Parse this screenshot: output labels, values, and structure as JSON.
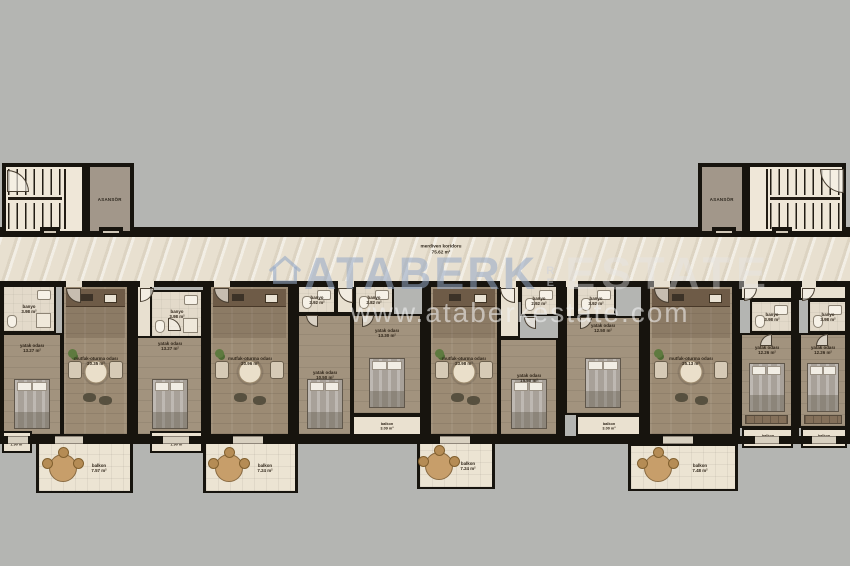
{
  "watermark": {
    "brand": "ATABERK",
    "mid": "RE",
    "brand2": "ESTATE",
    "url": "www.ataberkestate.com"
  },
  "corridor": {
    "label": "merdiven koridoru",
    "area": "75.62 m²"
  },
  "elevators": [
    {
      "label": "ASANSÖR"
    },
    {
      "label": "ASANSÖR"
    }
  ],
  "floorplan": {
    "rooms": [
      {
        "t": "bath",
        "n": "banyo",
        "a": "3.98 m²",
        "x": 2,
        "y": 285,
        "w": 54,
        "h": 48
      },
      {
        "t": "bedr",
        "n": "yatak odası",
        "a": "13.27 m²",
        "x": 2,
        "y": 333,
        "w": 60,
        "h": 103,
        "bed": 1,
        "ly": -37
      },
      {
        "t": "living",
        "n": "mutfak-oturma odası",
        "a": "20.35 m²",
        "x": 62,
        "y": 285,
        "w": 67,
        "h": 151,
        "k": 1,
        "tb": 1,
        "pl": 1
      },
      {
        "t": "balcony",
        "n": "balkon",
        "a": "1.90 m²",
        "x": 2,
        "y": 431,
        "w": 30,
        "h": 22
      },
      {
        "t": "balcony-out",
        "n": "balkon",
        "a": "7.57 m²",
        "x": 36,
        "y": 441,
        "w": 97,
        "h": 52,
        "bt": 1
      },
      {
        "t": "hall",
        "x": 136,
        "y": 285,
        "w": 16,
        "h": 53
      },
      {
        "t": "bath",
        "n": "banyo",
        "a": "3.98 m²",
        "x": 150,
        "y": 290,
        "w": 53,
        "h": 48
      },
      {
        "t": "bedr",
        "n": "yatak odası",
        "a": "13.27 m²",
        "x": 136,
        "y": 336,
        "w": 67,
        "h": 100,
        "bed": 1,
        "ly": -40
      },
      {
        "t": "living",
        "n": "mutfak-oturma odası",
        "a": "20.96 m²",
        "x": 209,
        "y": 285,
        "w": 81,
        "h": 151,
        "k": 1,
        "tb": 1,
        "pl": 1
      },
      {
        "t": "balcony",
        "n": "balkon",
        "a": "1.90 m²",
        "x": 150,
        "y": 431,
        "w": 53,
        "h": 22
      },
      {
        "t": "balcony-out",
        "n": "balkon",
        "a": "7.24 m²",
        "x": 203,
        "y": 441,
        "w": 95,
        "h": 52,
        "bt": 1
      },
      {
        "t": "bath",
        "n": "banyo",
        "a": "2.92 m²",
        "x": 297,
        "y": 285,
        "w": 39,
        "h": 29
      },
      {
        "t": "hall",
        "x": 336,
        "y": 285,
        "w": 18,
        "h": 29
      },
      {
        "t": "bath",
        "n": "banyo",
        "a": "2.82 m²",
        "x": 354,
        "y": 285,
        "w": 40,
        "h": 29
      },
      {
        "t": "bedr",
        "n": "yatak odası",
        "a": "10.50 m²",
        "x": 297,
        "y": 314,
        "w": 55,
        "h": 122,
        "bed": 1,
        "ly": 0
      },
      {
        "t": "bedr",
        "n": "yatak odası",
        "a": "13.30 m²",
        "x": 352,
        "y": 314,
        "w": 70,
        "h": 101,
        "bed": 1,
        "ly": -32
      },
      {
        "t": "balcony",
        "n": "balkon",
        "a": "3.09 m²",
        "x": 352,
        "y": 415,
        "w": 70,
        "h": 21
      },
      {
        "t": "living",
        "n": "mutfak-oturma odası",
        "a": "23.98 m²",
        "x": 429,
        "y": 285,
        "w": 70,
        "h": 151,
        "k": 1,
        "tb": 1,
        "pl": 1
      },
      {
        "t": "hall",
        "x": 499,
        "y": 285,
        "w": 21,
        "h": 53
      },
      {
        "t": "bath",
        "n": "banyo",
        "a": "2.92 m²",
        "x": 520,
        "y": 285,
        "w": 38,
        "h": 31
      },
      {
        "t": "bedr",
        "n": "yatak odası",
        "a": "15.50 m²",
        "x": 499,
        "y": 338,
        "w": 59,
        "h": 98,
        "bed": 1,
        "ly": -9
      },
      {
        "t": "balcony-out",
        "n": "balkon",
        "a": "7.24 m²",
        "x": 417,
        "y": 441,
        "w": 78,
        "h": 48,
        "bt": 1
      },
      {
        "t": "hall",
        "x": 565,
        "y": 285,
        "w": 11,
        "h": 53
      },
      {
        "t": "bath",
        "n": "banyo",
        "a": "3.92 m²",
        "x": 576,
        "y": 285,
        "w": 40,
        "h": 31
      },
      {
        "t": "bedr",
        "n": "yatak odası",
        "a": "12.50 m²",
        "x": 565,
        "y": 316,
        "w": 76,
        "h": 99,
        "bed": 1,
        "ly": -38
      },
      {
        "t": "balcony",
        "n": "balkon",
        "a": "3.00 m²",
        "x": 576,
        "y": 415,
        "w": 65,
        "h": 21
      },
      {
        "t": "living",
        "n": "mutfak-oturma odası",
        "a": "25.13 m²",
        "x": 648,
        "y": 285,
        "w": 86,
        "h": 151,
        "k": 1,
        "tb": 1,
        "pl": 1
      },
      {
        "t": "balcony-out",
        "n": "balkon",
        "a": "7.48 m²",
        "x": 628,
        "y": 443,
        "w": 110,
        "h": 48,
        "bt": 1
      },
      {
        "t": "hall",
        "x": 740,
        "y": 285,
        "w": 53,
        "h": 15
      },
      {
        "t": "bath",
        "n": "banyo",
        "a": "3.98 m²",
        "x": 750,
        "y": 300,
        "w": 43,
        "h": 33
      },
      {
        "t": "bedr",
        "n": "yatak odası",
        "a": "12.26 m²",
        "x": 740,
        "y": 333,
        "w": 53,
        "h": 95,
        "bed": 1,
        "ly": -31,
        "wd": 1
      },
      {
        "t": "balcony",
        "n": "balkon",
        "a": "1.88 m²",
        "x": 742,
        "y": 428,
        "w": 51,
        "h": 20
      },
      {
        "t": "hall",
        "x": 799,
        "y": 285,
        "w": 48,
        "h": 15
      },
      {
        "t": "bath",
        "n": "banyo",
        "a": "3.98 m²",
        "x": 808,
        "y": 300,
        "w": 39,
        "h": 33
      },
      {
        "t": "bedr",
        "n": "yatak odası",
        "a": "12.26 m²",
        "x": 799,
        "y": 333,
        "w": 48,
        "h": 95,
        "bed": 1,
        "ly": -31,
        "wd": 1
      },
      {
        "t": "balcony",
        "n": "balkon",
        "a": "1.88 m²",
        "x": 801,
        "y": 428,
        "w": 46,
        "h": 20
      }
    ],
    "walls": [
      {
        "x": 0,
        "y": 227,
        "w": 850,
        "h": 10
      },
      {
        "x": 0,
        "y": 281,
        "w": 850,
        "h": 6
      },
      {
        "x": 0,
        "y": 436,
        "w": 850,
        "h": 8
      },
      {
        "x": 0,
        "y": 281,
        "w": 3,
        "h": 163
      },
      {
        "x": 129,
        "y": 281,
        "w": 7,
        "h": 163
      },
      {
        "x": 203,
        "y": 281,
        "w": 6,
        "h": 163
      },
      {
        "x": 290,
        "y": 281,
        "w": 7,
        "h": 163
      },
      {
        "x": 422,
        "y": 281,
        "w": 7,
        "h": 163
      },
      {
        "x": 558,
        "y": 281,
        "w": 7,
        "h": 163
      },
      {
        "x": 641,
        "y": 281,
        "w": 7,
        "h": 163
      },
      {
        "x": 734,
        "y": 281,
        "w": 6,
        "h": 163
      },
      {
        "x": 793,
        "y": 281,
        "w": 6,
        "h": 163
      },
      {
        "x": 845,
        "y": 281,
        "w": 5,
        "h": 163
      }
    ],
    "gaps": [
      {
        "x": 66,
        "y": 281,
        "w": 16,
        "h": 6,
        "k": "in"
      },
      {
        "x": 140,
        "y": 281,
        "w": 14,
        "h": 6,
        "k": "in"
      },
      {
        "x": 214,
        "y": 281,
        "w": 16,
        "h": 6,
        "k": "in"
      },
      {
        "x": 338,
        "y": 281,
        "w": 16,
        "h": 6,
        "k": "in"
      },
      {
        "x": 500,
        "y": 281,
        "w": 16,
        "h": 6,
        "k": "in"
      },
      {
        "x": 566,
        "y": 281,
        "w": 12,
        "h": 6,
        "k": "in"
      },
      {
        "x": 654,
        "y": 281,
        "w": 16,
        "h": 6,
        "k": "in"
      },
      {
        "x": 744,
        "y": 281,
        "w": 14,
        "h": 6,
        "k": "in"
      },
      {
        "x": 802,
        "y": 281,
        "w": 14,
        "h": 6,
        "k": "in"
      },
      {
        "x": 8,
        "y": 436,
        "w": 20,
        "h": 8,
        "k": "out"
      },
      {
        "x": 55,
        "y": 436,
        "w": 28,
        "h": 8,
        "k": "out"
      },
      {
        "x": 163,
        "y": 436,
        "w": 26,
        "h": 8,
        "k": "out"
      },
      {
        "x": 233,
        "y": 436,
        "w": 30,
        "h": 8,
        "k": "out"
      },
      {
        "x": 440,
        "y": 436,
        "w": 30,
        "h": 8,
        "k": "out"
      },
      {
        "x": 663,
        "y": 436,
        "w": 30,
        "h": 8,
        "k": "out"
      },
      {
        "x": 755,
        "y": 436,
        "w": 24,
        "h": 8,
        "k": "out"
      },
      {
        "x": 812,
        "y": 436,
        "w": 24,
        "h": 8,
        "k": "out"
      },
      {
        "x": 99,
        "y": 227,
        "w": 24,
        "h": 10,
        "k": "lift"
      },
      {
        "x": 712,
        "y": 227,
        "w": 24,
        "h": 10,
        "k": "lift"
      },
      {
        "x": 40,
        "y": 227,
        "w": 20,
        "h": 10,
        "k": "lift"
      },
      {
        "x": 772,
        "y": 227,
        "w": 20,
        "h": 10,
        "k": "lift"
      }
    ],
    "arcs": [
      {
        "x": 66,
        "y": 288,
        "s": 15,
        "d": "sw"
      },
      {
        "x": 140,
        "y": 288,
        "s": 14,
        "d": "se"
      },
      {
        "x": 214,
        "y": 288,
        "s": 15,
        "d": "sw"
      },
      {
        "x": 338,
        "y": 288,
        "s": 15,
        "d": "sw"
      },
      {
        "x": 500,
        "y": 288,
        "s": 15,
        "d": "sw"
      },
      {
        "x": 654,
        "y": 288,
        "s": 15,
        "d": "sw"
      },
      {
        "x": 744,
        "y": 288,
        "s": 13,
        "d": "se"
      },
      {
        "x": 802,
        "y": 288,
        "s": 13,
        "d": "se"
      },
      {
        "x": 168,
        "y": 318,
        "s": 13,
        "d": "ne"
      },
      {
        "x": 306,
        "y": 315,
        "s": 12,
        "d": "sw"
      },
      {
        "x": 362,
        "y": 315,
        "s": 12,
        "d": "se"
      },
      {
        "x": 524,
        "y": 317,
        "s": 12,
        "d": "sw"
      },
      {
        "x": 580,
        "y": 317,
        "s": 12,
        "d": "se"
      },
      {
        "x": 760,
        "y": 334,
        "s": 12,
        "d": "nw"
      },
      {
        "x": 816,
        "y": 334,
        "s": 12,
        "d": "nw"
      },
      {
        "x": 7,
        "y": 170,
        "s": 22,
        "d": "ne"
      },
      {
        "x": 820,
        "y": 169,
        "s": 24,
        "d": "sw"
      }
    ]
  }
}
